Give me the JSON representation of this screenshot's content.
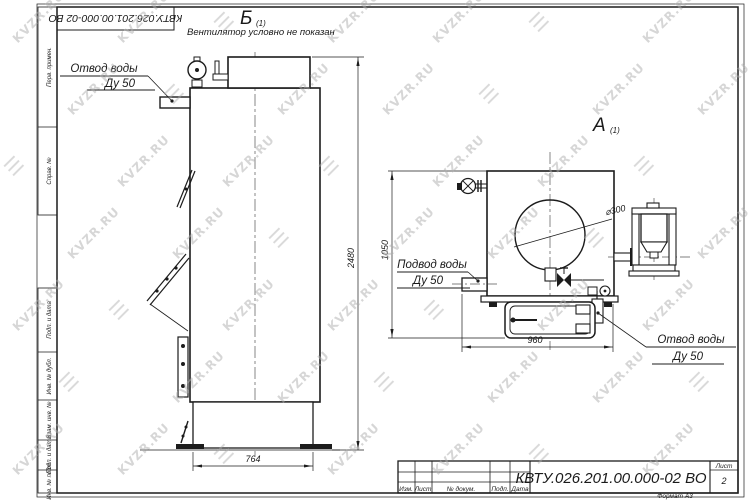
{
  "watermark": {
    "text": "KVZR.RU",
    "logo": "☰"
  },
  "stamp_top": "КВТУ.026.201.00.000-02  ВО",
  "margin_labels": {
    "perv": "Перв. примен.",
    "sprav": "Справ. №",
    "podp1": "Подп. и дата",
    "inv_dubl": "Инв. № дубл.",
    "vzam": "Взам. инв. №",
    "podp2": "Подп. и дата",
    "inv_podl": "Инв. № подл."
  },
  "views": {
    "b": {
      "label": "Б",
      "sub": "(1)",
      "note": "Вентилятор условно не показан"
    },
    "a": {
      "label": "А",
      "sub": "(1)"
    }
  },
  "callouts": {
    "otvod_top": {
      "line1": "Отвод воды",
      "line2": "Ду 50"
    },
    "podvod": {
      "line1": "Подвод воды",
      "line2": "Ду 50"
    },
    "otvod_bottom": {
      "line1": "Отвод воды",
      "line2": "Ду 50"
    }
  },
  "dimensions": {
    "height_total": "2480",
    "width_base": "764",
    "height_front": "1050",
    "width_front": "960",
    "flue_diameter": "⌀300"
  },
  "titleblock": {
    "designation": "КВТУ.026.201.00.000-02  ВО",
    "columns": {
      "izm": "Изм.",
      "list": "Лист",
      "doc": "№ докум.",
      "podp": "Подп.",
      "data": "Дата"
    },
    "sheet_label": "Лист",
    "sheet_number": "2",
    "format": "Формат А3"
  }
}
